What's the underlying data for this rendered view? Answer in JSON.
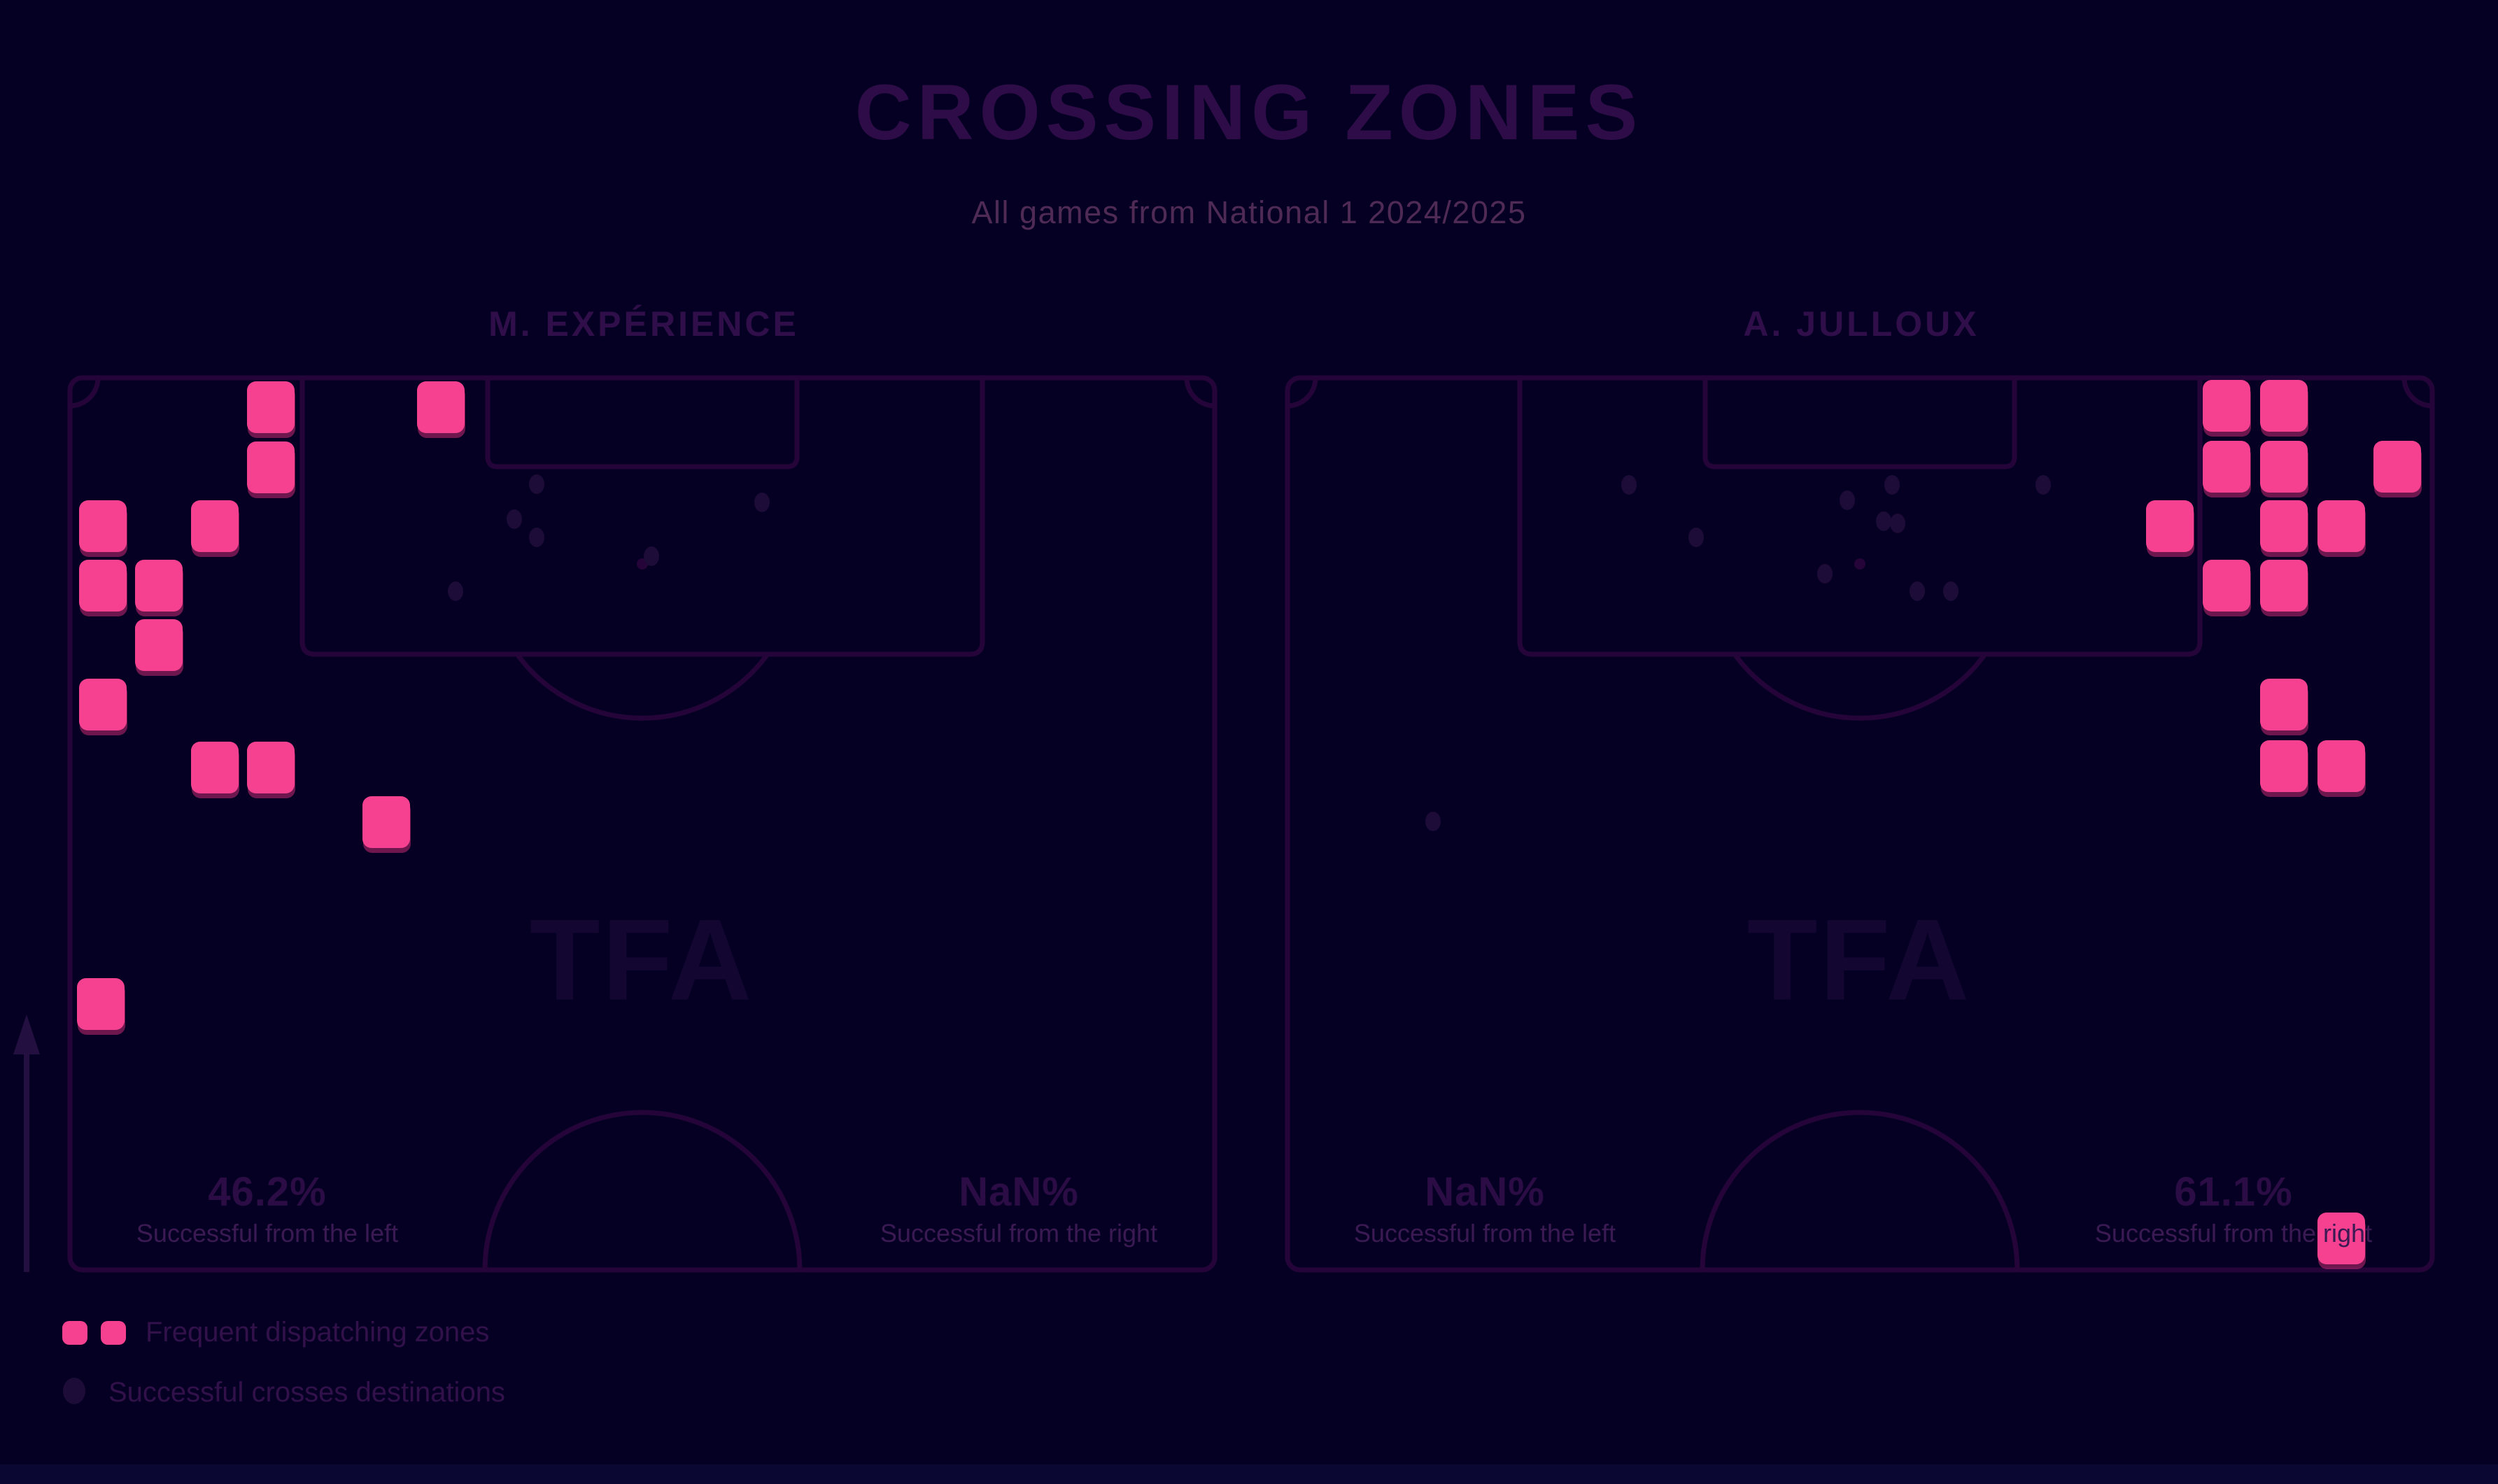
{
  "title": "CROSSING ZONES",
  "subtitle": "All games from National 1 2024/2025",
  "watermark": "TFA",
  "legend": {
    "zones": "Frequent dispatching zones",
    "destinations": "Successful crosses destinations"
  },
  "icons": {
    "arrow": "attack-direction-up-arrow",
    "zone_marker": "pink-rounded-square",
    "destination_marker": "dark-ellipse-dot"
  },
  "colors": {
    "bg": "#050023",
    "line": "#250539",
    "zone": "#f5418f",
    "zone_shadow": "#b3276b",
    "dot": "#1d0b38",
    "title": "#2e0c48",
    "subtitle": "#4e2a55",
    "player": "#300e4a",
    "pct": "#2b0c44",
    "stat_label": "#3b1a53",
    "legend_text": "#32114b",
    "watermark": "#130732",
    "arrow": "#241040",
    "footer": "#0a0733"
  },
  "chart_data": {
    "type": "heatmap",
    "title": "CROSSING ZONES",
    "subtitle": "All games from National 1 2024/2025",
    "legend_position": "bottom-left",
    "marker": {
      "square_w": 68,
      "square_h": 74,
      "square_rx": 13,
      "dot_rx": 11,
      "dot_ry": 14
    },
    "pitches": [
      {
        "player": "M. EXPÉRIENCE",
        "stats": [
          {
            "value": "46.2%",
            "label": "Successful from the left"
          },
          {
            "value": "NaN%",
            "label": "Successful from the right"
          }
        ],
        "squares": [
          [
            353,
            545
          ],
          [
            596,
            545
          ],
          [
            353,
            631
          ],
          [
            113,
            715
          ],
          [
            273,
            715
          ],
          [
            113,
            800
          ],
          [
            193,
            800
          ],
          [
            193,
            885
          ],
          [
            113,
            970
          ],
          [
            273,
            1060
          ],
          [
            353,
            1060
          ],
          [
            518,
            1138
          ],
          [
            110,
            1398
          ]
        ],
        "dots": [
          [
            767,
            692
          ],
          [
            735,
            742
          ],
          [
            767,
            768
          ],
          [
            1089,
            718
          ],
          [
            931,
            795
          ],
          [
            651,
            845
          ]
        ]
      },
      {
        "player": "A. JULLOUX",
        "stats": [
          {
            "value": "NaN%",
            "label": "Successful from the left"
          },
          {
            "value": "61.1%",
            "label": "Successful from the right"
          }
        ],
        "squares": [
          [
            3148,
            543
          ],
          [
            3230,
            543
          ],
          [
            3148,
            630
          ],
          [
            3230,
            630
          ],
          [
            3392,
            630
          ],
          [
            3067,
            715
          ],
          [
            3230,
            715
          ],
          [
            3312,
            715
          ],
          [
            3148,
            800
          ],
          [
            3230,
            800
          ],
          [
            3230,
            970
          ],
          [
            3230,
            1058
          ],
          [
            3312,
            1058
          ],
          [
            3312,
            1733
          ]
        ],
        "dots": [
          [
            2328,
            693
          ],
          [
            2704,
            693
          ],
          [
            2640,
            715
          ],
          [
            2692,
            745
          ],
          [
            2712,
            748
          ],
          [
            2920,
            693
          ],
          [
            2424,
            768
          ],
          [
            2608,
            820
          ],
          [
            2740,
            845
          ],
          [
            2788,
            845
          ],
          [
            2048,
            1174
          ]
        ]
      }
    ]
  }
}
